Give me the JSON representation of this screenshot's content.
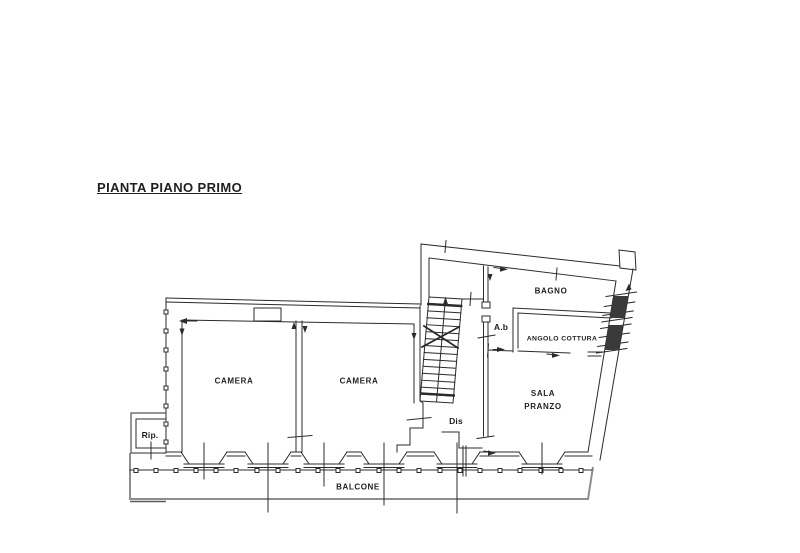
{
  "title": {
    "text": "PIANTA PIANO PRIMO"
  },
  "plan": {
    "rooms": {
      "camera1": "CAMERA",
      "camera2": "CAMERA",
      "bagno": "BAGNO",
      "angolo_cottura": "ANGOLO COTTURA",
      "sala_pranzo_line1": "SALA",
      "sala_pranzo_line2": "PRANZO",
      "anti_bagno": "A.b",
      "disimpegno": "Dis",
      "ripostiglio": "Rip.",
      "balcone": "BALCONE"
    },
    "colors": {
      "line": "#2b2b2b",
      "balcony": "#8e8e8e",
      "balcony_accent": "#5a5a66",
      "text": "#1f1f1f",
      "window_fill": "#3a3a3a"
    }
  }
}
